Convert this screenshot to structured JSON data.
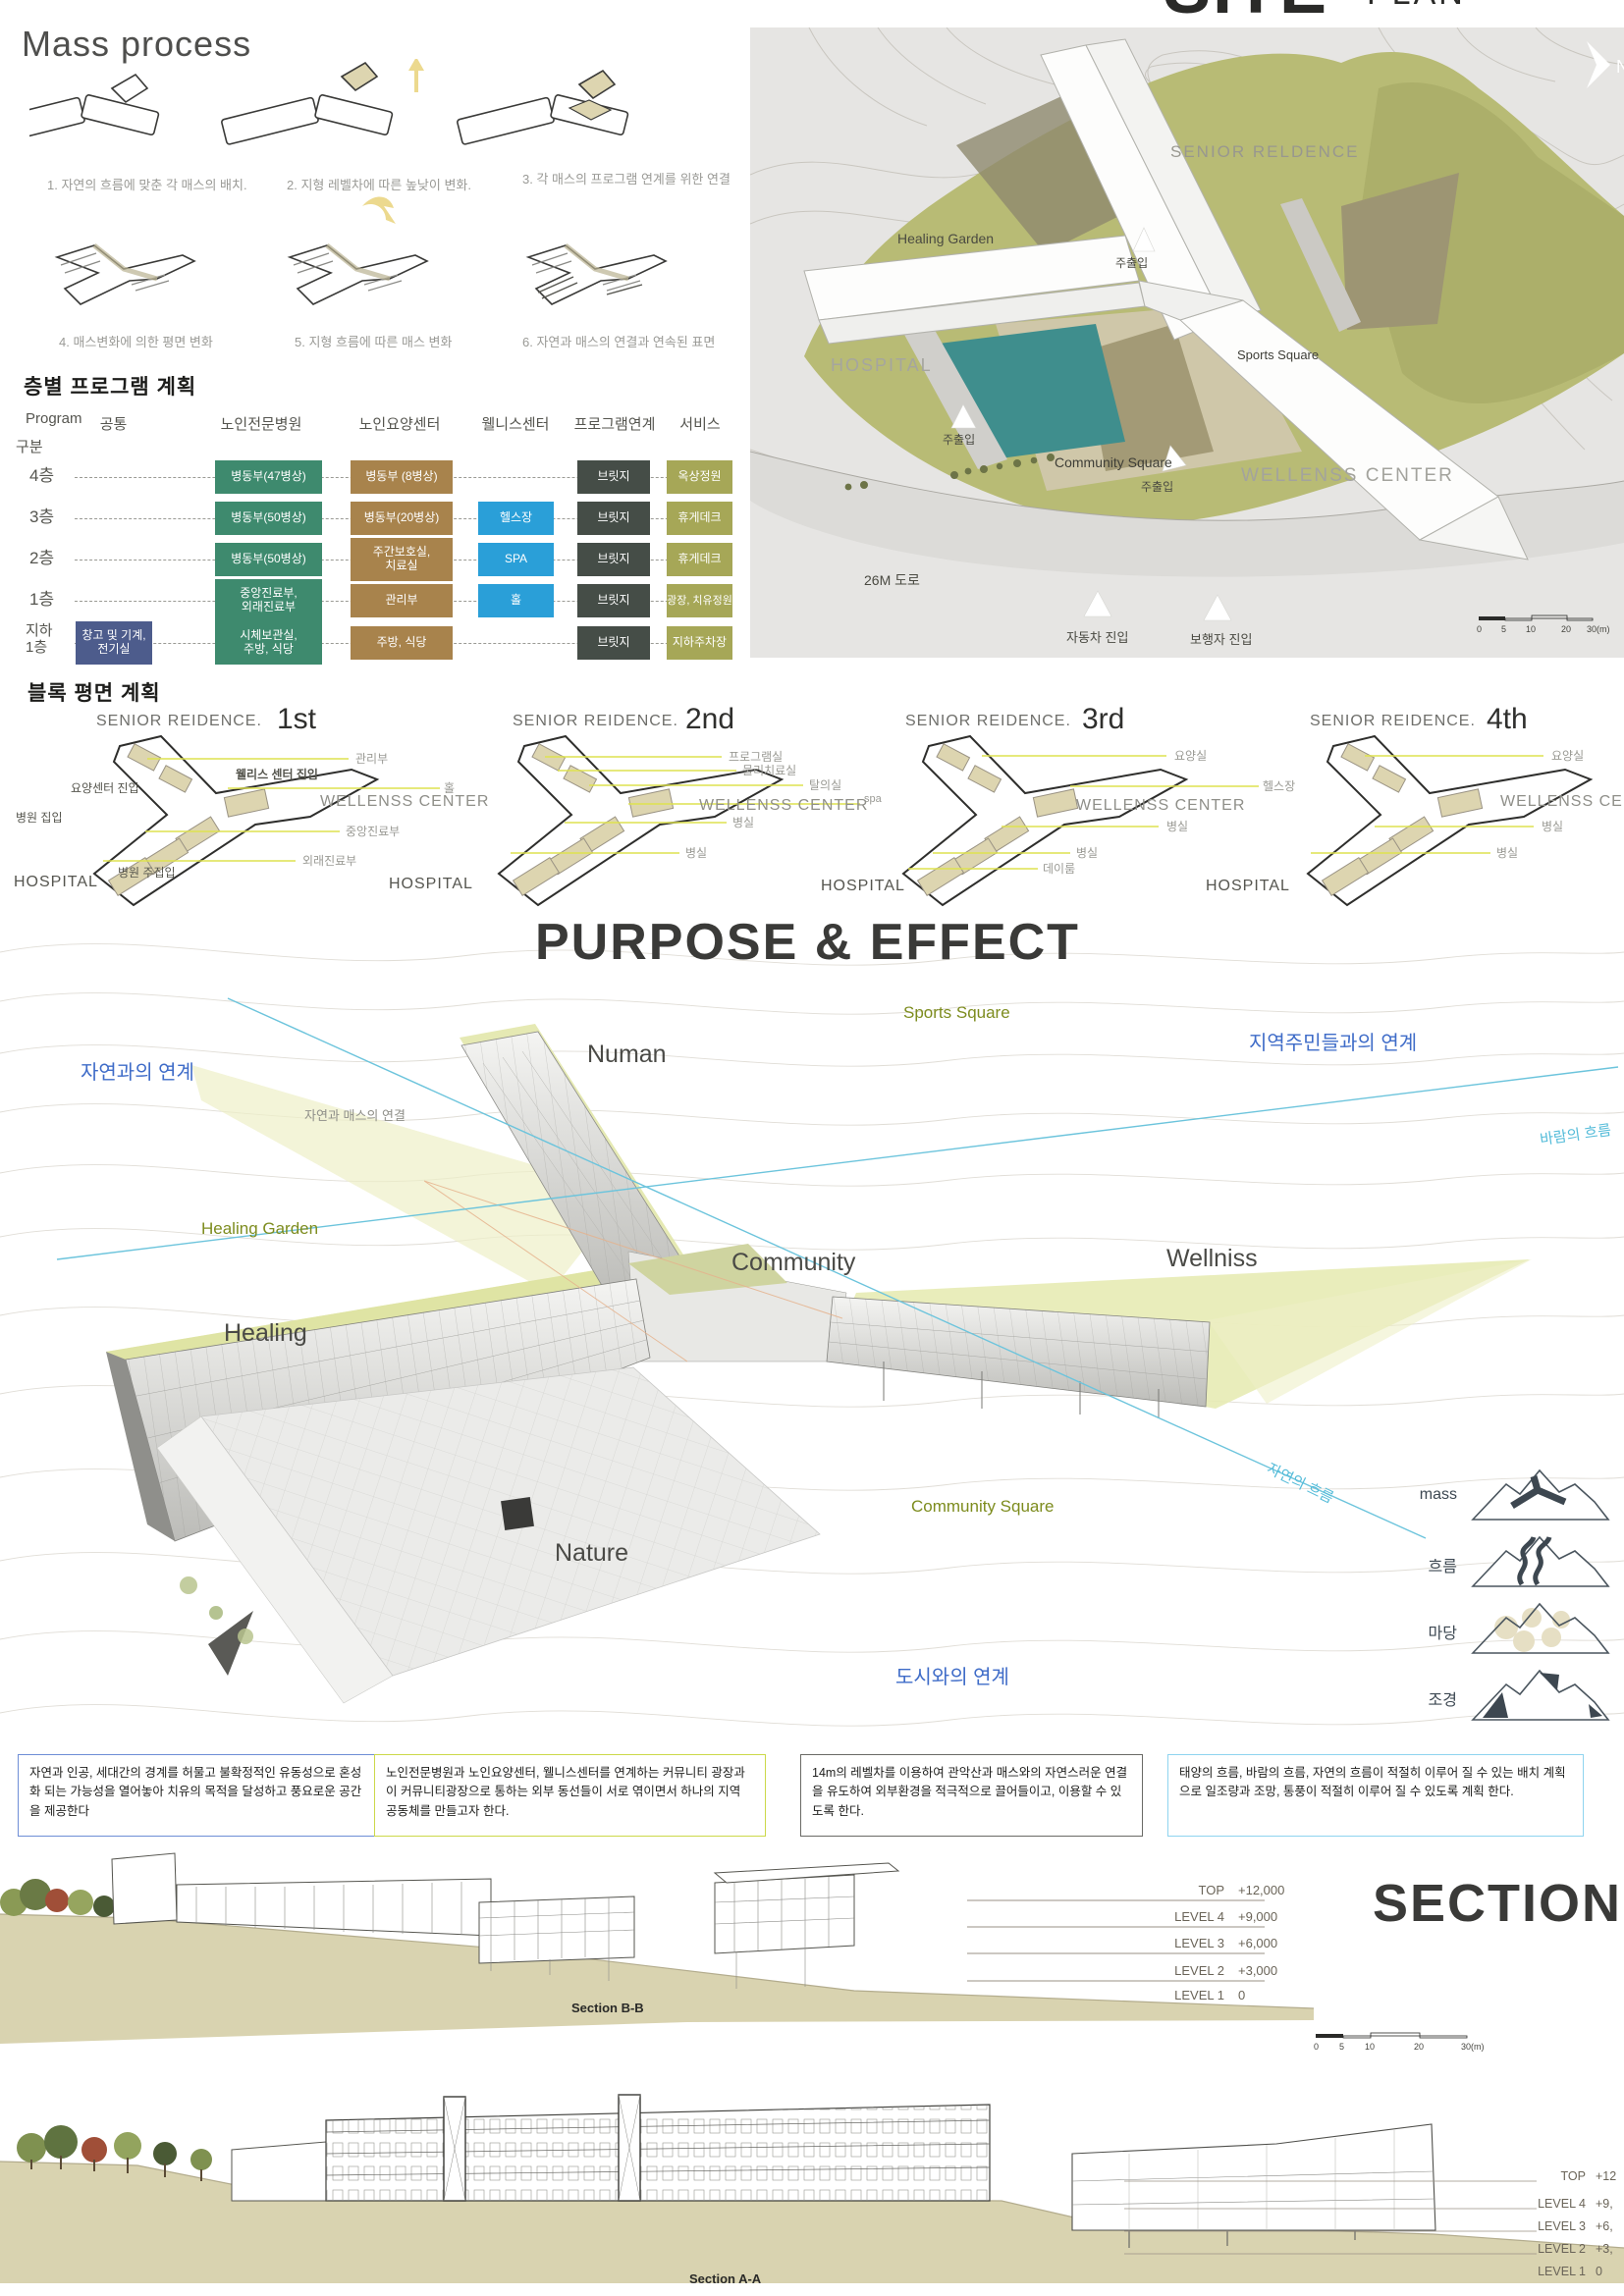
{
  "mass_process": {
    "title": "Mass process",
    "steps": [
      {
        "caption": "1. 자연의 흐름에 맞춘 각 매스의 배치."
      },
      {
        "caption": "2. 지형 레벨차에 따른 높낮이 변화."
      },
      {
        "caption": "3. 각 매스의 프로그램 연계를 위한 연결"
      },
      {
        "caption": "4. 매스변화에 의한 평면 변화"
      },
      {
        "caption": "5. 지형 흐름에 따른 매스 변화"
      },
      {
        "caption": "6. 자연과 매스의 연결과 연속된 표면"
      }
    ]
  },
  "floor_program": {
    "title": "층별 프로그램 계획",
    "corner_top": "Program",
    "corner_bottom": "구분",
    "columns": [
      "공통",
      "노인전문병원",
      "노인요양센터",
      "웰니스센터",
      "프로그램연계",
      "서비스"
    ],
    "colors": {
      "common": "#4d5c8c",
      "hospital": "#3e8a6e",
      "care": "#a8834c",
      "wellness": "#2a9fd8",
      "bridge": "#454d47",
      "service": "#a6a757"
    },
    "rows": [
      {
        "floor": "4층",
        "hospital": "병동부(47병상)",
        "care": "병동부 (8병상)",
        "bridge": "브릿지",
        "service": "옥상정원"
      },
      {
        "floor": "3층",
        "hospital": "병동부(50병상)",
        "care": "병동부(20병상)",
        "wellness": "헬스장",
        "bridge": "브릿지",
        "service": "휴게데크"
      },
      {
        "floor": "2층",
        "hospital": "병동부(50병상)",
        "care": "주간보호실,\n치료실",
        "wellness": "SPA",
        "bridge": "브릿지",
        "service": "휴게데크"
      },
      {
        "floor": "1층",
        "hospital": "중앙진료부,\n외래진료부",
        "care": "관리부",
        "wellness": "홀",
        "bridge": "브릿지",
        "service": "광장, 치유정원"
      },
      {
        "floor": "지하\n1층",
        "common": "창고 및 기계,\n전기실",
        "hospital": "시체보관실,\n주방, 식당",
        "care": "주방, 식당",
        "bridge": "브릿지",
        "service": "지하주차장"
      }
    ]
  },
  "site_plan": {
    "title_main": "SITE",
    "title_sub": "PLAN",
    "north": "N",
    "labels": {
      "senior": "SENIOR RELDENCE",
      "healing_garden": "Healing Garden",
      "hospital": "HOSPITAL",
      "sports_square": "Sports Square",
      "community_square": "Community Square",
      "wellness": "WELLENSS CENTER",
      "road": "26M 도로",
      "entry_main": "주출입",
      "entry_car": "자동차 진입",
      "entry_ped": "보행자 진입"
    },
    "scale_ticks": [
      "0",
      "5",
      "10",
      "20",
      "30(m)"
    ]
  },
  "block_plan": {
    "title": "블록 평면 계획",
    "floors": [
      {
        "name": "1st",
        "senior": "SENIOR REIDENCE.",
        "wellness": "WELLENSS CENTER",
        "hospital": "HOSPITAL",
        "labels": [
          "관리부",
          "웰리스 센터 집입",
          "홀",
          "요양센터 진입",
          "병원 집입",
          "중앙진료부",
          "외래진료부",
          "병원 주집입"
        ]
      },
      {
        "name": "2nd",
        "senior": "SENIOR REIDENCE.",
        "wellness": "WELLENSS CENTER",
        "hospital": "HOSPITAL",
        "labels": [
          "프로그램실",
          "물리치료실",
          "탈의실",
          "spa",
          "병실",
          "병실"
        ]
      },
      {
        "name": "3rd",
        "senior": "SENIOR REIDENCE.",
        "wellness": "WELLENSS CENTER",
        "hospital": "HOSPITAL",
        "labels": [
          "요양실",
          "헬스장",
          "병실",
          "병실",
          "데이룸"
        ]
      },
      {
        "name": "4th",
        "senior": "SENIOR REIDENCE.",
        "wellness": "WELLENSS CENTER",
        "hospital": "HOSPITAL",
        "labels": [
          "요양실",
          "병실",
          "병실"
        ]
      }
    ]
  },
  "purpose": {
    "title": "PURPOSE & EFFECT",
    "labels": {
      "sports_square": "Sports Square",
      "link_residents": "지역주민들과의 연계",
      "link_nature": "자연과의 연계",
      "numan": "Numan",
      "nature_mass": "자연과 매스의 연결",
      "wind_flow": "바람의 흐름",
      "healing_garden": "Healing Garden",
      "community": "Community",
      "wellniss": "Wellniss",
      "healing": "Healing",
      "nature_flow": "자연의 흐름",
      "community_square": "Community Square",
      "nature": "Nature",
      "link_city": "도시와의 연계"
    },
    "legend": [
      {
        "label": "mass"
      },
      {
        "label": "흐름"
      },
      {
        "label": "마당"
      },
      {
        "label": "조경"
      }
    ],
    "notes": [
      {
        "border": "#6e8ed6",
        "text": "자연과 인공, 세대간의 경계를 허물고 불확정적인 유동성으로 혼성화 되는 가능성을 열어놓아 치유의 목적을 달성하고 풍요로운 공간을 제공한다"
      },
      {
        "border": "#ccd84a",
        "text": "노인전문병원과 노인요양센터, 웰니스센터를 연계하는 커뮤니티 광장과 이 커뮤니티광장으로 통하는 외부 동선들이 서로 엮이면서 하나의 지역 공동체를 만들고자 한다."
      },
      {
        "border": "#6a6a66",
        "text": "14m의 레벨차를 이용하여 관악산과 매스와의 자연스러운 연결을 유도하여 외부환경을 적극적으로 끌어들이고, 이용할 수 있도록 한다."
      },
      {
        "border": "#8fd4ef",
        "text": "태양의 흐름, 바람의 흐름, 자연의 흐름이 적절히 이루어 질 수 있는 배치 계획으로 일조량과 조망, 통풍이 적절히 이루어 질 수 있도록 계획 한다."
      }
    ]
  },
  "sections": {
    "title": "SECTION",
    "bb": {
      "label": "Section B-B",
      "levels": [
        {
          "name": "TOP",
          "value": "+12,000"
        },
        {
          "name": "LEVEL 4",
          "value": "+9,000"
        },
        {
          "name": "LEVEL 3",
          "value": "+6,000"
        },
        {
          "name": "LEVEL 2",
          "value": "+3,000"
        },
        {
          "name": "LEVEL 1",
          "value": "0"
        }
      ],
      "scale_ticks": [
        "0",
        "5",
        "10",
        "20",
        "30(m)"
      ]
    },
    "aa": {
      "label": "Section A-A",
      "levels": [
        {
          "name": "TOP",
          "value": "+12"
        },
        {
          "name": "LEVEL 4",
          "value": "+9,"
        },
        {
          "name": "LEVEL 3",
          "value": "+6,"
        },
        {
          "name": "LEVEL 2",
          "value": "+3,"
        },
        {
          "name": "LEVEL 1",
          "value": "0"
        }
      ]
    }
  }
}
